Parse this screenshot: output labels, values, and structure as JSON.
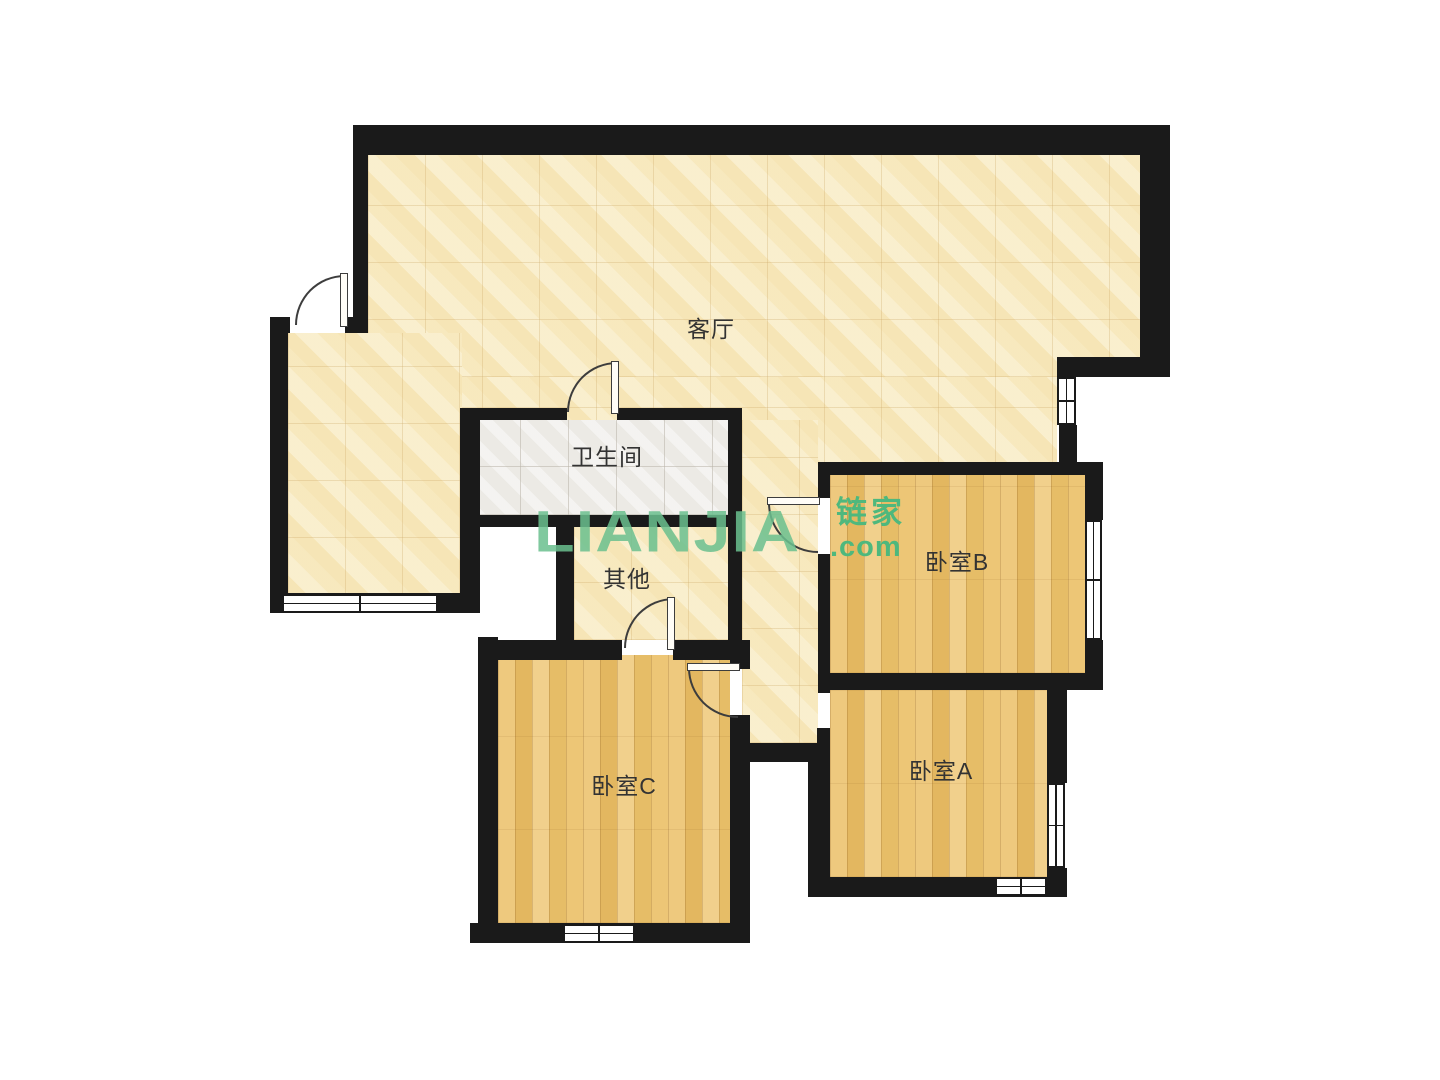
{
  "canvas": {
    "width": 1440,
    "height": 1080,
    "background": "#ffffff"
  },
  "palette": {
    "wall": "#1a1a1a",
    "tile_floor": "#f8ecc6",
    "wood_floor": "#e9c172",
    "bath_floor": "#eceae5",
    "label_color": "#333333",
    "watermark_main_color": "#6bc08f",
    "watermark_side_color": "#4eb87d"
  },
  "watermark": {
    "main": "LIANJIA",
    "cjk": "链家",
    "com": ".com",
    "main_x": 534,
    "main_y": 497,
    "side_x": 836,
    "cjk_y": 497,
    "com_y": 533
  },
  "rooms": [
    {
      "id": "living",
      "label": "客厅",
      "floor": "tile",
      "label_x": 711,
      "label_y": 327
    },
    {
      "id": "bathroom",
      "label": "卫生间",
      "floor": "bath",
      "label_x": 607,
      "label_y": 455
    },
    {
      "id": "other",
      "label": "其他",
      "floor": "tile",
      "label_x": 627,
      "label_y": 577
    },
    {
      "id": "bedroom-b",
      "label": "卧室B",
      "floor": "wood",
      "label_x": 957,
      "label_y": 560
    },
    {
      "id": "bedroom-c",
      "label": "卧室C",
      "floor": "wood",
      "label_x": 624,
      "label_y": 784
    },
    {
      "id": "bedroom-a",
      "label": "卧室A",
      "floor": "wood",
      "label_x": 941,
      "label_y": 769
    }
  ],
  "floors": [
    {
      "room": "living",
      "type": "tile",
      "x": 368,
      "y": 155,
      "w": 784,
      "h": 222
    },
    {
      "room": "living",
      "type": "tile",
      "x": 368,
      "y": 377,
      "w": 689,
      "h": 88
    },
    {
      "room": "living",
      "type": "tile",
      "x": 288,
      "y": 333,
      "w": 174,
      "h": 262
    },
    {
      "room": "living",
      "type": "tile",
      "x": 742,
      "y": 420,
      "w": 76,
      "h": 323
    },
    {
      "room": "bathroom",
      "type": "bath",
      "x": 472,
      "y": 420,
      "w": 256,
      "h": 95
    },
    {
      "room": "other",
      "type": "tile",
      "x": 574,
      "y": 527,
      "w": 154,
      "h": 113
    },
    {
      "room": "bedroom-b",
      "type": "wood",
      "x": 830,
      "y": 475,
      "w": 255,
      "h": 198
    },
    {
      "room": "bedroom-a",
      "type": "wood",
      "x": 830,
      "y": 690,
      "w": 217,
      "h": 187
    },
    {
      "room": "bedroom-c",
      "type": "wood",
      "x": 498,
      "y": 655,
      "w": 232,
      "h": 268
    }
  ],
  "walls": [
    [
      353,
      125,
      817,
      30
    ],
    [
      1140,
      125,
      30,
      252
    ],
    [
      1057,
      357,
      113,
      20
    ],
    [
      1059,
      425,
      18,
      40
    ],
    [
      353,
      125,
      15,
      208
    ],
    [
      345,
      317,
      23,
      16
    ],
    [
      270,
      317,
      20,
      16
    ],
    [
      270,
      317,
      18,
      296
    ],
    [
      270,
      593,
      210,
      20
    ],
    [
      460,
      408,
      20,
      205
    ],
    [
      460,
      408,
      107,
      12
    ],
    [
      617,
      408,
      125,
      12
    ],
    [
      460,
      515,
      282,
      12
    ],
    [
      556,
      515,
      18,
      145
    ],
    [
      728,
      408,
      14,
      252
    ],
    [
      478,
      640,
      144,
      20
    ],
    [
      673,
      640,
      77,
      20
    ],
    [
      478,
      637,
      20,
      306
    ],
    [
      470,
      923,
      280,
      20
    ],
    [
      730,
      660,
      20,
      9
    ],
    [
      730,
      715,
      20,
      210
    ],
    [
      818,
      462,
      12,
      36
    ],
    [
      818,
      554,
      12,
      139
    ],
    [
      817,
      728,
      13,
      16
    ],
    [
      733,
      743,
      97,
      19
    ],
    [
      808,
      743,
      22,
      154
    ],
    [
      818,
      462,
      285,
      13
    ],
    [
      818,
      673,
      285,
      17
    ],
    [
      1085,
      462,
      18,
      58
    ],
    [
      1085,
      640,
      18,
      50
    ],
    [
      1047,
      690,
      20,
      93
    ],
    [
      1047,
      868,
      20,
      29
    ],
    [
      808,
      877,
      239,
      20
    ]
  ],
  "windows": [
    {
      "name": "entry-window",
      "x": 282,
      "y": 594,
      "w": 156,
      "h": 19,
      "orient": "h"
    },
    {
      "name": "living-right-window",
      "x": 1057,
      "y": 377,
      "w": 19,
      "h": 48,
      "orient": "v"
    },
    {
      "name": "bedroom-b-window",
      "x": 1085,
      "y": 520,
      "w": 17,
      "h": 120,
      "orient": "v"
    },
    {
      "name": "bedroom-a-side-window",
      "x": 1047,
      "y": 783,
      "w": 18,
      "h": 85,
      "orient": "v"
    },
    {
      "name": "bedroom-a-bottom-window",
      "x": 995,
      "y": 877,
      "w": 52,
      "h": 19,
      "orient": "h"
    },
    {
      "name": "bedroom-c-window",
      "x": 563,
      "y": 924,
      "w": 72,
      "h": 19,
      "orient": "h"
    }
  ],
  "doors": [
    {
      "name": "entry-door",
      "x": 295,
      "y": 275,
      "r": 50,
      "corner": "tl",
      "leaf": [
        340,
        273,
        8,
        54
      ]
    },
    {
      "name": "bathroom-door",
      "x": 567,
      "y": 362,
      "r": 50,
      "corner": "tl",
      "leaf": [
        611,
        361,
        8,
        53
      ]
    },
    {
      "name": "other-door",
      "x": 624,
      "y": 598,
      "r": 50,
      "corner": "tl",
      "leaf": [
        667,
        597,
        8,
        53
      ]
    },
    {
      "name": "bedroom-c-door",
      "x": 688,
      "y": 668,
      "r": 50,
      "corner": "bl",
      "leaf": [
        687,
        663,
        53,
        8
      ]
    },
    {
      "name": "bedroom-b-door",
      "x": 768,
      "y": 503,
      "r": 50,
      "corner": "bl",
      "leaf": [
        767,
        497,
        53,
        8
      ]
    }
  ]
}
